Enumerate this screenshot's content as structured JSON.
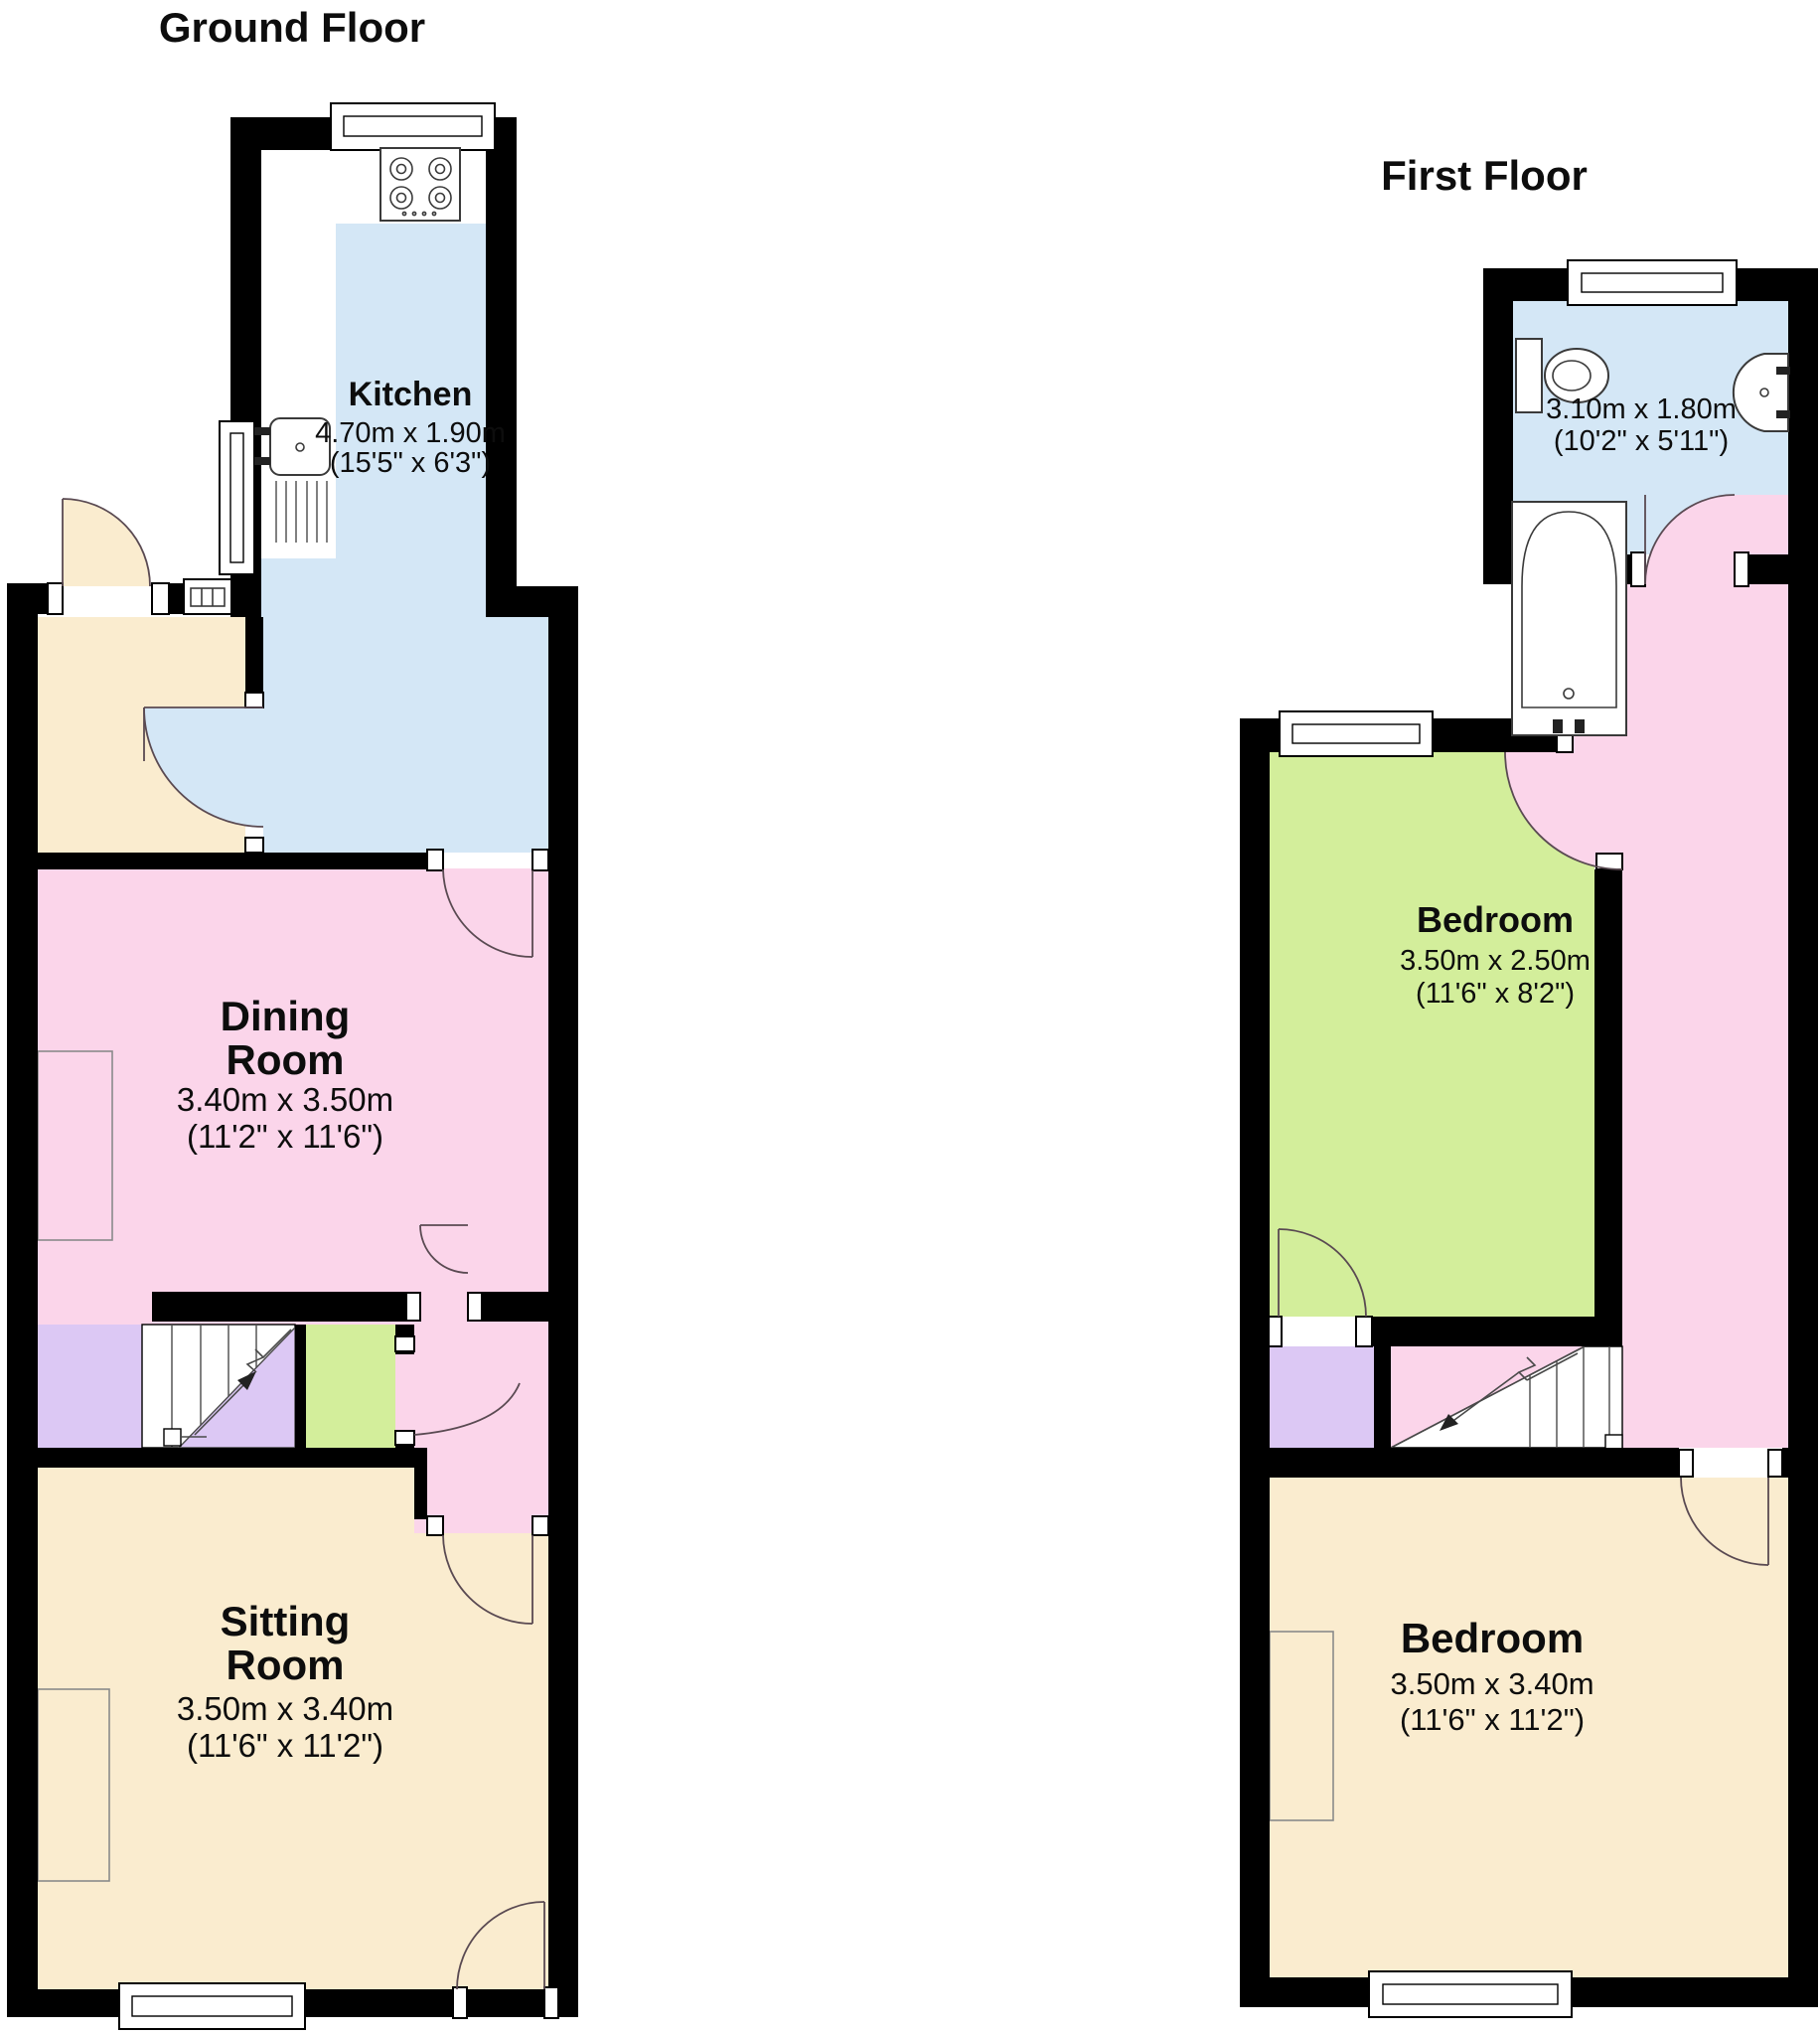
{
  "colors": {
    "wall": "#000000",
    "kitchen_blue": "#d4e7f6",
    "pink": "#fbd5ea",
    "cream": "#faeccf",
    "green": "#d3ee9b",
    "purple": "#dcc8f4"
  },
  "ground_floor": {
    "title": "Ground Floor",
    "kitchen": {
      "name": "Kitchen",
      "metric": "4.70m x 1.90m",
      "imperial": "(15'5\" x 6'3\")"
    },
    "dining_room": {
      "name_line1": "Dining",
      "name_line2": "Room",
      "metric": "3.40m x 3.50m",
      "imperial": "(11'2\" x 11'6\")"
    },
    "sitting_room": {
      "name_line1": "Sitting",
      "name_line2": "Room",
      "metric": "3.50m x 3.40m",
      "imperial": "(11'6\" x 11'2\")"
    }
  },
  "first_floor": {
    "title": "First Floor",
    "bathroom": {
      "metric": "3.10m x 1.80m",
      "imperial": "(10'2\" x 5'11\")"
    },
    "bedroom_rear": {
      "name": "Bedroom",
      "metric": "3.50m x 2.50m",
      "imperial": "(11'6\" x 8'2\")"
    },
    "bedroom_front": {
      "name": "Bedroom",
      "metric": "3.50m x 3.40m",
      "imperial": "(11'6\" x 11'2\")"
    }
  }
}
